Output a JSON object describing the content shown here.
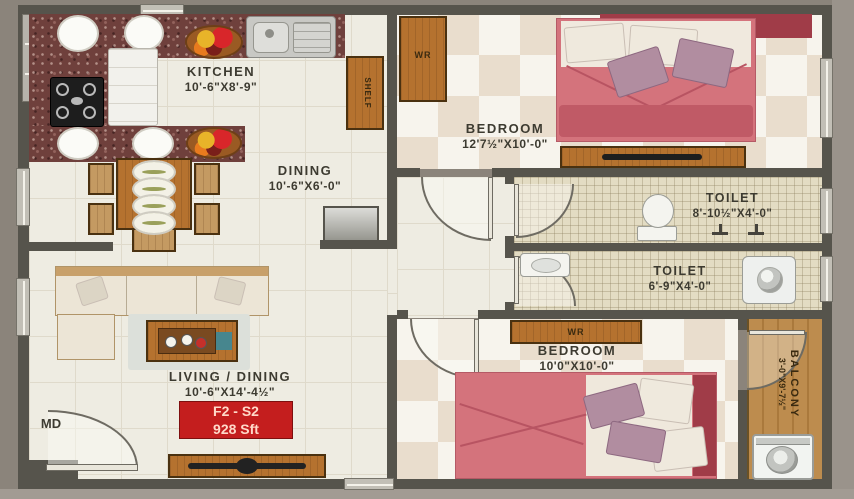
{
  "badge": {
    "code": "F2 - S2",
    "area": "928 Sft",
    "bg": "#c41e1e"
  },
  "rooms": {
    "kitchen": {
      "name": "KITCHEN",
      "dims": "10'-6\"X8'-9\""
    },
    "dining": {
      "name": "DINING",
      "dims": "10'-6\"X6'-0\""
    },
    "living": {
      "name": "LIVING / DINING",
      "dims": "10'-6\"X14'-4½\""
    },
    "bedroom1": {
      "name": "BEDROOM",
      "dims": "12'7½\"X10'-0\""
    },
    "toilet1": {
      "name": "TOILET",
      "dims": "8'-10½\"X4'-0\""
    },
    "toilet2": {
      "name": "TOILET",
      "dims": "6'-9\"X4'-0\""
    },
    "bedroom2": {
      "name": "BEDROOM",
      "dims": "10'0\"X10'-0\""
    },
    "balcony": {
      "name": "BALCONY",
      "dims": "3'-0\"X9'-7½\""
    }
  },
  "markers": {
    "main_door": "MD",
    "wardrobe_bedroom1": "WR",
    "wardrobe_bedroom2": "WR",
    "kitchen_shelf": "SHELF"
  },
  "colors": {
    "wall": "#56544c",
    "bed": "#d4737c",
    "headboard": "#a03c48",
    "badge_text": "#ffd9c9"
  }
}
